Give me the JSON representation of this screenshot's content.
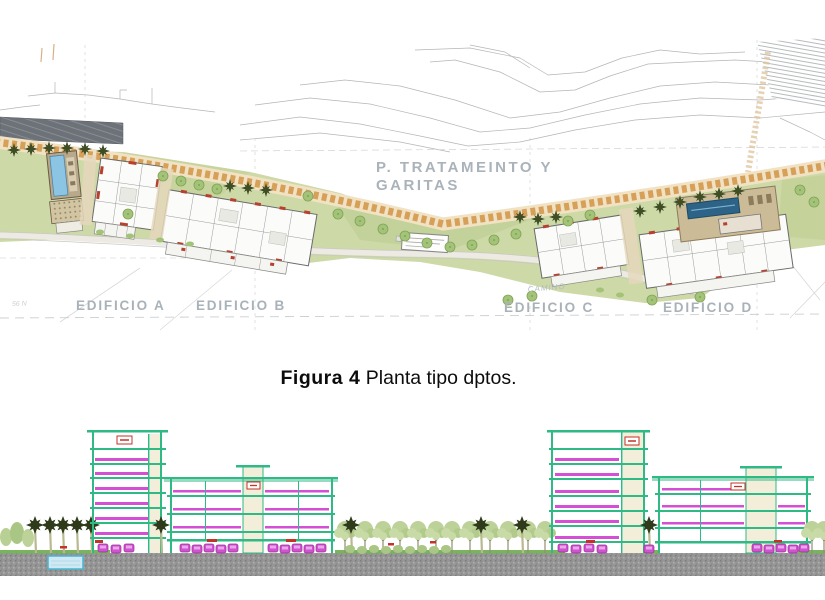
{
  "figure": {
    "caption_bold": "Figura  4",
    "caption_rest": "Planta tipo dptos."
  },
  "site_plan": {
    "treatment_area_label_line1": "P. TRATAMEINTO Y",
    "treatment_area_label_line2": "GARITAS",
    "building_labels": [
      "EDIFICIO A",
      "EDIFICIO B",
      "EDIFICIO C",
      "EDIFICIO D"
    ],
    "road_label": "CAMINO",
    "edge_note": "56 N"
  },
  "colors": {
    "plan_green": "#cdd9a6",
    "stone_band_stone": "#d6a059",
    "stone_band_base": "#f1e2c4",
    "pool_blue": "#8cc4e4",
    "deck_tan": "#cbbb97",
    "label_gray": "#a9b2b8",
    "elevation_structure_teal": "#2fb985",
    "elevation_accent_magenta": "#d44fd4",
    "elevation_sign_red": "#c23328",
    "elevation_core_cream": "#f3eed9",
    "ground_gravel_gray": "#969696",
    "tree_light_green": "#bcd298",
    "palm_dark_green": "#2f3a1a"
  }
}
